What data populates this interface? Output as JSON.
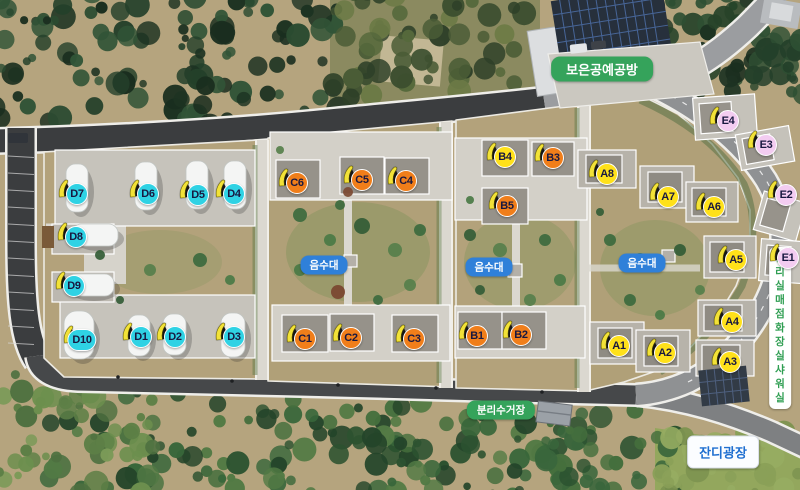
{
  "labels": {
    "craft_shop": "보은공예공방",
    "water": "음수대",
    "recycling": "분리수거장",
    "lawn_plaza": "잔디광장",
    "facility_lines": [
      "관리실",
      "매점",
      "화장실",
      "샤워실"
    ]
  },
  "badge_colors": {
    "water_bg": "#2f80d9",
    "green_bg": "#35a35b",
    "lawn_text": "#1f6fd0",
    "facility_text": "#2f9e52"
  },
  "marker_text_color": "#181840",
  "marker_colors": {
    "A": "#ffe11a",
    "B": "#f07e1a",
    "C": "#f07e1a",
    "D": "#2fd2e4",
    "E": "#f3ccf1",
    "B4": "#ffe11a"
  },
  "markers": [
    {
      "label": "D7",
      "group": "D",
      "x": 77,
      "y": 194
    },
    {
      "label": "D6",
      "group": "D",
      "x": 148,
      "y": 194
    },
    {
      "label": "D5",
      "group": "D",
      "x": 198,
      "y": 195
    },
    {
      "label": "D4",
      "group": "D",
      "x": 234,
      "y": 194
    },
    {
      "label": "D8",
      "group": "D",
      "x": 76,
      "y": 237
    },
    {
      "label": "D9",
      "group": "D",
      "x": 74,
      "y": 286
    },
    {
      "label": "D10",
      "group": "D",
      "x": 82,
      "y": 340
    },
    {
      "label": "D1",
      "group": "D",
      "x": 141,
      "y": 337
    },
    {
      "label": "D2",
      "group": "D",
      "x": 175,
      "y": 337
    },
    {
      "label": "D3",
      "group": "D",
      "x": 234,
      "y": 337
    },
    {
      "label": "C6",
      "group": "C",
      "x": 297,
      "y": 183
    },
    {
      "label": "C5",
      "group": "C",
      "x": 362,
      "y": 180
    },
    {
      "label": "C4",
      "group": "C",
      "x": 406,
      "y": 181
    },
    {
      "label": "C1",
      "group": "C",
      "x": 305,
      "y": 339
    },
    {
      "label": "C2",
      "group": "C",
      "x": 351,
      "y": 338
    },
    {
      "label": "C3",
      "group": "C",
      "x": 414,
      "y": 339
    },
    {
      "label": "B4",
      "group": "B",
      "x": 505,
      "y": 157
    },
    {
      "label": "B3",
      "group": "B",
      "x": 553,
      "y": 158
    },
    {
      "label": "B5",
      "group": "B",
      "x": 507,
      "y": 206
    },
    {
      "label": "B1",
      "group": "B",
      "x": 477,
      "y": 336
    },
    {
      "label": "B2",
      "group": "B",
      "x": 521,
      "y": 335
    },
    {
      "label": "A8",
      "group": "A",
      "x": 607,
      "y": 174
    },
    {
      "label": "A7",
      "group": "A",
      "x": 668,
      "y": 197
    },
    {
      "label": "A6",
      "group": "A",
      "x": 714,
      "y": 207
    },
    {
      "label": "A5",
      "group": "A",
      "x": 736,
      "y": 260
    },
    {
      "label": "A4",
      "group": "A",
      "x": 732,
      "y": 322
    },
    {
      "label": "A3",
      "group": "A",
      "x": 730,
      "y": 362
    },
    {
      "label": "A1",
      "group": "A",
      "x": 619,
      "y": 346
    },
    {
      "label": "A2",
      "group": "A",
      "x": 665,
      "y": 353
    },
    {
      "label": "E4",
      "group": "E",
      "x": 728,
      "y": 121
    },
    {
      "label": "E3",
      "group": "E",
      "x": 766,
      "y": 145
    },
    {
      "label": "E2",
      "group": "E",
      "x": 786,
      "y": 195
    },
    {
      "label": "E1",
      "group": "E",
      "x": 788,
      "y": 258
    }
  ]
}
